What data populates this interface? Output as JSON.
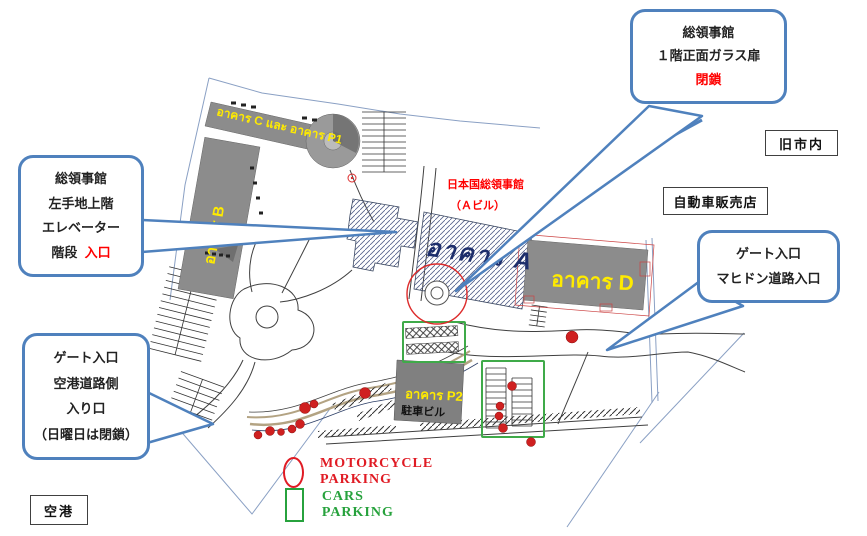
{
  "callouts": {
    "glass_door": {
      "line1": "総領事館",
      "line2": "１階正面ガラス扉",
      "line3": "閉鎖"
    },
    "entrance": {
      "line1": "総領事館",
      "line2": "左手地上階",
      "line3": "エレベーター",
      "line4_black": "階段",
      "line4_red": "入口"
    },
    "gate_mahidol": {
      "line1": "ゲート入口",
      "line2": "マヒドン道路入口"
    },
    "gate_airport": {
      "line1": "ゲート入口",
      "line2": "空港道路側",
      "line3": "入り口",
      "line4": "（日曜日は閉鎖）"
    }
  },
  "boxes": {
    "old_town": "旧市内",
    "car_dealer": "自動車販売店",
    "airport": "空港"
  },
  "map_labels": {
    "consulate_red_1": "日本国総領事館",
    "consulate_red_2": "（Ａビル）",
    "building_a": "อาคาร A",
    "building_b": "อาคาร B",
    "building_c_p1": "อาคาร C และ อาคาร P1",
    "building_d": "อาคาร D",
    "building_p2": "อาคาร P2",
    "parking_building": "駐車ビル"
  },
  "legend": {
    "motorcycle": "MOTORCYCLE PARKING",
    "cars": "CARS PARKING"
  },
  "colors": {
    "callout_blue": "#4f81bd",
    "building_gray": "#8c8c8c",
    "label_yellow": "#ffeb00",
    "alert_red": "#ff0000",
    "legend_red": "#e01b24",
    "legend_green": "#27a23d",
    "parking_green": "#3faa49",
    "dot_red": "#cf2020"
  }
}
